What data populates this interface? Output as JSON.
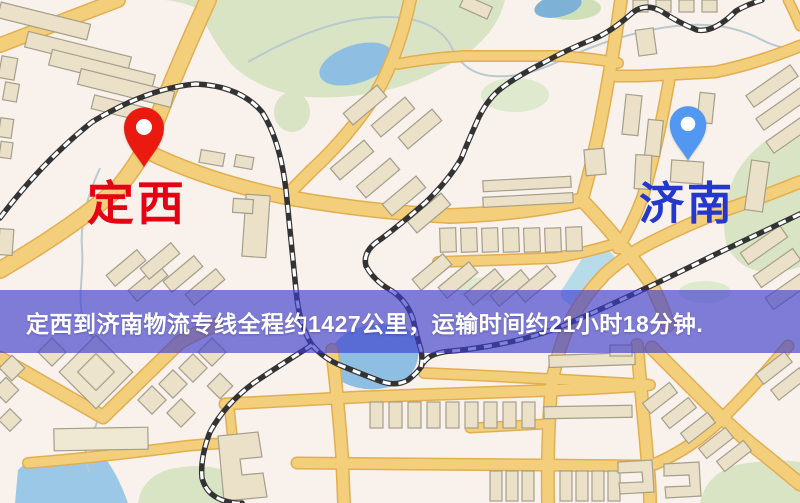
{
  "page": {
    "width": 800,
    "height": 503,
    "kind": "logistics-route-map"
  },
  "map": {
    "origin": {
      "label": "定西",
      "label_color": "#e60012",
      "pin_color": "#ea1b0e"
    },
    "destination": {
      "label": "济南",
      "label_color": "#2438cd",
      "pin_color": "#5398f0"
    },
    "feature_colors": {
      "background": "#f8f1ec",
      "road": "#f3cf7c",
      "road_border": "#e2ae4f",
      "railway": "#333333",
      "railway_dash": "#ffffff",
      "water": "#8ebfe2",
      "park": "#d9e4c4",
      "building": "#eae1c8",
      "building_outline": "#a59e8b",
      "stream": "#b9c9cf"
    }
  },
  "banner": {
    "text": "定西到济南物流专线全程约1427公里，运输时间约21小时18分钟.",
    "origin_city": "定西",
    "destination_city": "济南",
    "distance_text": "约1427公里",
    "duration_text": "约21小时18分钟",
    "background_color": "rgba(62,62,205,0.65)",
    "text_color": "#ffffff"
  }
}
